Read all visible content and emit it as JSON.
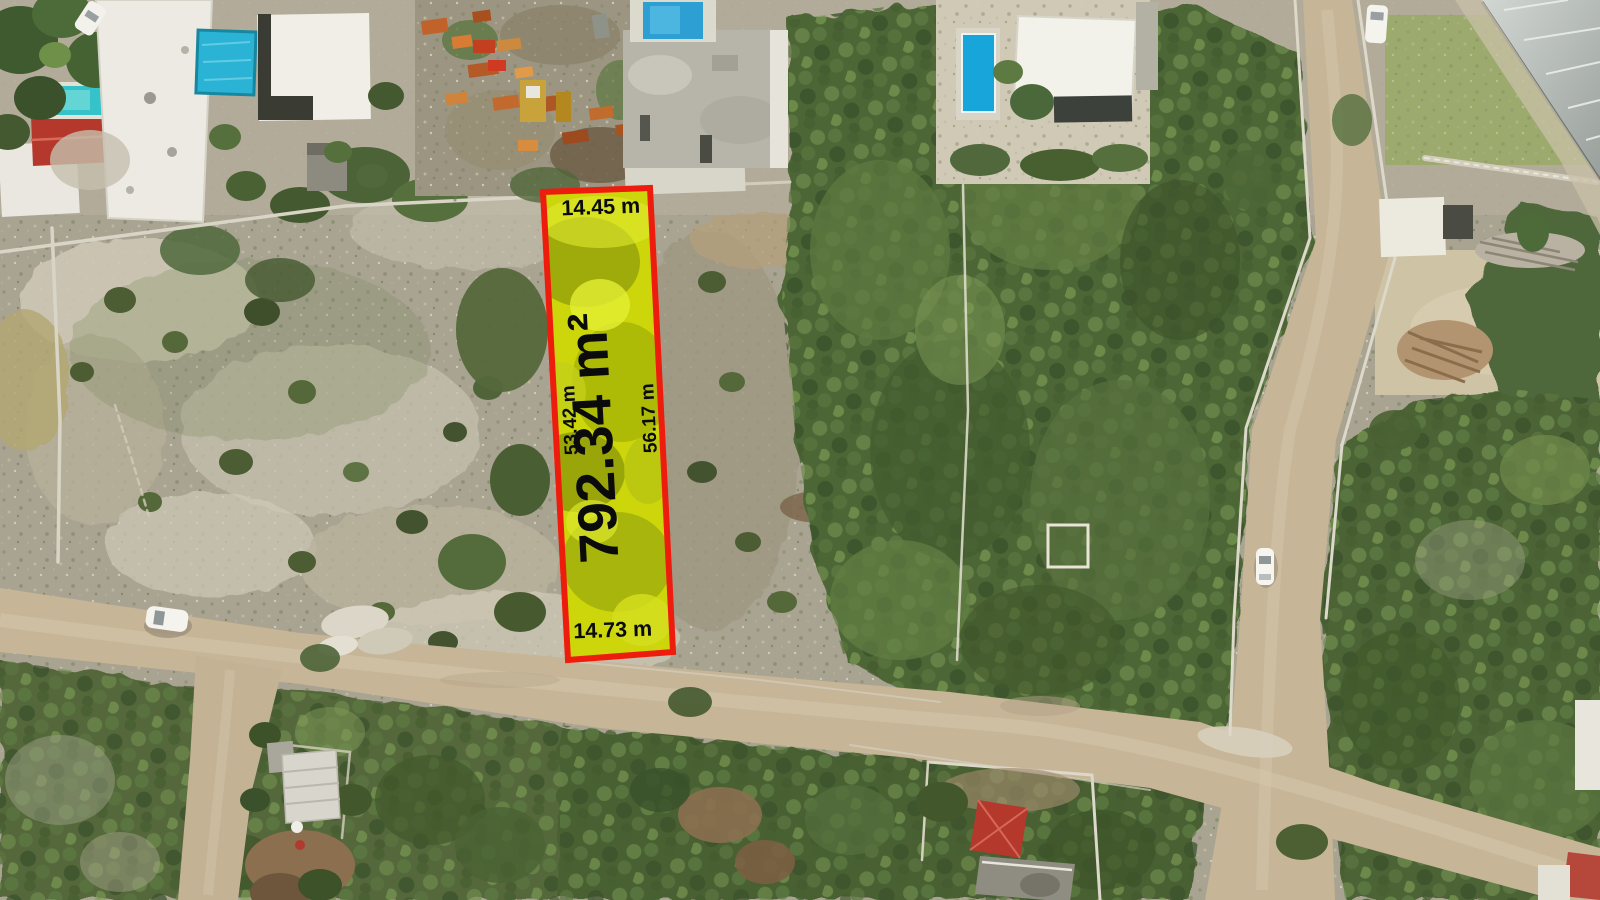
{
  "photo": {
    "kind": "aerial-drone-photo",
    "subject": "vacant land lot highlighted for sale beside dirt roads, houses with pools, a machinery yard and dense trees"
  },
  "parcel": {
    "polygon_points": "543,192 650,188 673,652 568,660",
    "area_label": "792.34 m²",
    "side_top": "14.45 m",
    "side_left": "53.42 m",
    "side_right": "56.17 m",
    "side_bottom": "14.73 m",
    "outline_color": "#ee1c0c",
    "fill_color": "#d9e411",
    "label_color": "#0b0b0b"
  },
  "scene_colors": {
    "scrub_ground": "#a9a392",
    "rocky_patch": "#cdc7b5",
    "forest_green": "#4e6636",
    "dirt_road": "#c6b597",
    "pool_blue": "#18a6da",
    "red_roof": "#b5382c",
    "wall_gray": "#dcd8ca"
  }
}
